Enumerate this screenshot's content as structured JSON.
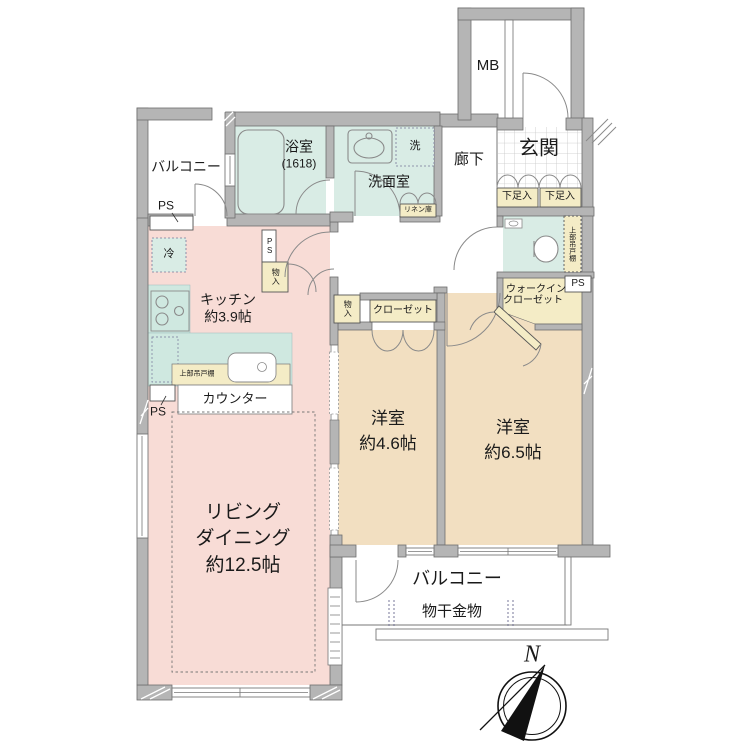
{
  "title": "マンション間取り図 (apartment floor plan)",
  "colors": {
    "wall": "#b5b5b5",
    "wall_edge": "#6e6e6e",
    "ldk_floor": "#f8dcd6",
    "bedroom_floor": "#f2dfc1",
    "wet_area": "#d9ece5",
    "closet_fill": "#f4ecc6",
    "line": "#888888",
    "text": "#1a1a1a"
  },
  "labels": {
    "mb": "MB",
    "entrance": "玄関",
    "hallway": "廊下",
    "shoe_left": "下足入",
    "shoe_right": "下足入",
    "balcony_top": "バルコニー",
    "ps_top": "PS",
    "bath": "浴室",
    "bath_size": "(1618)",
    "washroom": "洗面室",
    "washer": "洗",
    "linen": "リネン庫",
    "toilet_cabinet": "上部吊戸棚",
    "ps_right": "PS",
    "wic_line1": "ウォークイン",
    "wic_line2": "クローゼット",
    "kitchen": "キッチン",
    "kitchen_size": "約3.9帖",
    "fridge": "冷",
    "storage_kitchen": "物入",
    "ps_kitchen": "PS",
    "kitchen_cabinet": "上部吊戸棚",
    "counter": "カウンター",
    "ps_left": "PS",
    "living_line1": "リビング",
    "living_line2": "ダイニング",
    "living_size": "約12.5帖",
    "closet": "クローゼット",
    "storage_bedroom1": "物入",
    "bedroom1": "洋室",
    "bedroom1_size": "約4.6帖",
    "bedroom2": "洋室",
    "bedroom2_size": "約6.5帖",
    "balcony_bottom": "バルコニー",
    "laundry_hardware": "物干金物",
    "north": "N"
  }
}
